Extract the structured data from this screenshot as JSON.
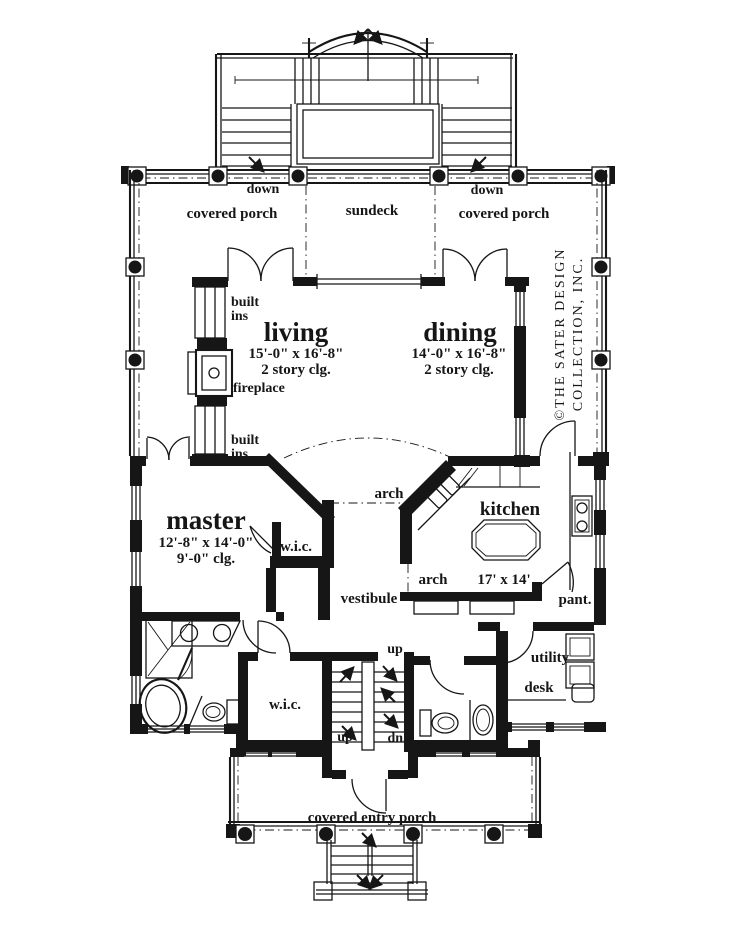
{
  "colors": {
    "ink": "#161616",
    "paper": "#ffffff"
  },
  "rooms": {
    "living": {
      "name": "living",
      "dims": "15'-0\" x 16'-8\"",
      "ceiling": "2 story clg."
    },
    "dining": {
      "name": "dining",
      "dims": "14'-0\" x 16'-8\"",
      "ceiling": "2 story clg."
    },
    "master": {
      "name": "master",
      "dims": "12'-8\" x 14'-0\"",
      "ceiling": "9'-0\" clg."
    },
    "kitchen": {
      "name": "kitchen",
      "dims": "17' x 14'"
    },
    "vestibule": {
      "name": "vestibule"
    },
    "utility": {
      "name": "utility"
    },
    "pantry": {
      "name": "pant."
    },
    "desk": {
      "name": "desk"
    },
    "wic_master": {
      "name": "w.i.c."
    },
    "wic_hall": {
      "name": "w.i.c."
    }
  },
  "porches": {
    "left": "covered porch",
    "sundeck": "sundeck",
    "right": "covered porch",
    "entry": "covered entry porch"
  },
  "stairs": {
    "down_left": "down",
    "down_right": "down",
    "up_hall": "up",
    "up_entry": "up",
    "down_basement": "dn."
  },
  "features": {
    "fireplace": "fireplace",
    "built_ins_upper": [
      "built",
      "ins"
    ],
    "built_ins_lower": [
      "built",
      "ins"
    ],
    "arch_vestibule": "arch",
    "arch_kitchen": "arch"
  },
  "copyright": {
    "line1": "©THE SATER DESIGN",
    "line2": "COLLECTION, INC."
  }
}
